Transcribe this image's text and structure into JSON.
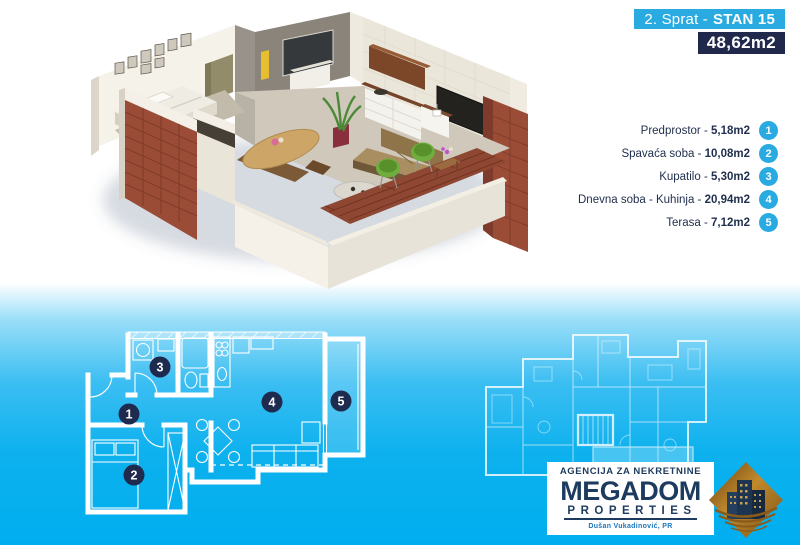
{
  "banner": {
    "floor": "2. Sprat -",
    "unit": "STAN 15",
    "total_area": "48,62m2"
  },
  "list": {
    "separator": " - "
  },
  "rooms": [
    {
      "num": "1",
      "name": "Predprostor",
      "area": "5,18m2"
    },
    {
      "num": "2",
      "name": "Spavaća soba",
      "area": "10,08m2"
    },
    {
      "num": "3",
      "name": "Kupatilo",
      "area": "5,30m2"
    },
    {
      "num": "4",
      "name": "Dnevna soba - Kuhinja",
      "area": "20,94m2"
    },
    {
      "num": "5",
      "name": "Terasa",
      "area": "7,12m2"
    }
  ],
  "logo": {
    "tagline": "AGENCIJA ZA NEKRETNINE",
    "brand": "MEGADOM",
    "brand_sub": "PROPERTIES",
    "owner": "Dušan Vukadinović, PR"
  },
  "colors": {
    "accent_blue": "#29ABE2",
    "navy": "#20294B",
    "gradient_bottom": "#00AEEF",
    "logo_navy": "#1D3B5E",
    "logo_gold": "#A8762A",
    "brick": "#9A4C36"
  }
}
